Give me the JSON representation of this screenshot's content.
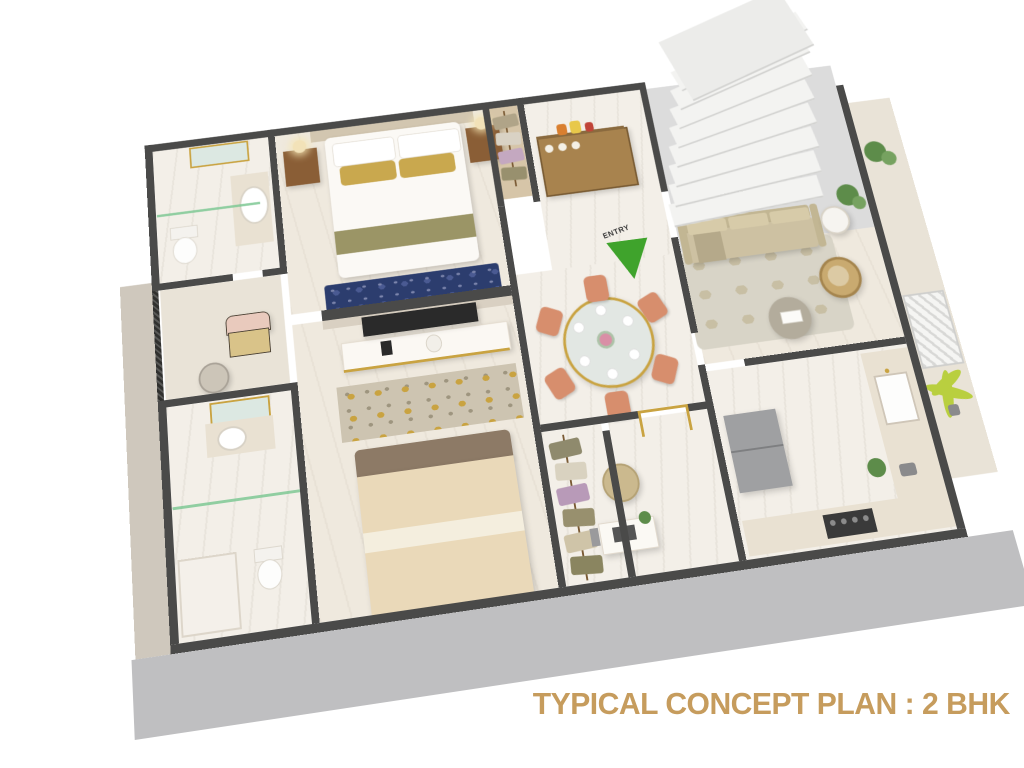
{
  "title": {
    "text": "TYPICAL CONCEPT PLAN : 2 BHK"
  },
  "entry_marker": {
    "label": "ENTRY"
  },
  "palette": {
    "titlegold": "#c69c5d",
    "green": "#3fa32c",
    "wall": "#4a4a49",
    "marble": "#f3efe8",
    "marble2": "#efe9de",
    "stone": "#dcdcdc",
    "woodf": "#d6c5a8",
    "balcony": "#e9e3d7",
    "plinth": "#bfbfc1",
    "plinthl": "#cfc8bd",
    "gold": "#c9a341",
    "bluerug": "#2c3d6e",
    "sofa": "#cdc1a2",
    "coral": "#d78e6d",
    "plant": "#5d8c4a",
    "palm": "#b9cf3f",
    "wood": "#8a5e36",
    "cream": "#ead9b9",
    "brown": "#8d7a66",
    "olive": "#9b9566",
    "goldpillow": "#c9a84e",
    "fridge": "#9fa0a2",
    "glassgreen": "#7ec894"
  }
}
